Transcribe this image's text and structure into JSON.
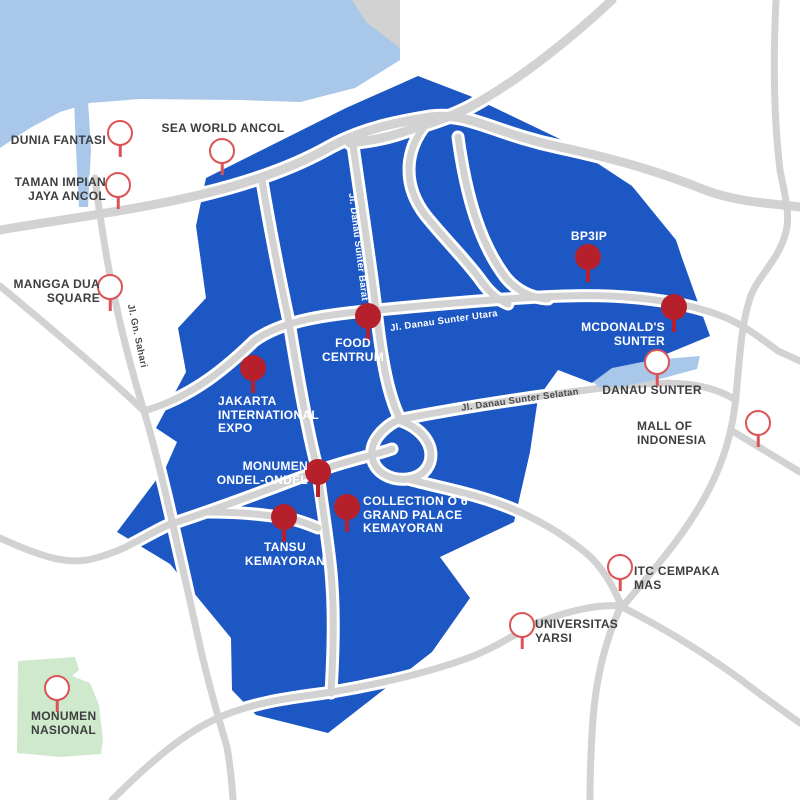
{
  "map_title": "Kemayoran - Sunter area illustrated map",
  "colors": {
    "district_blue": "#1d57c4",
    "water_blue": "#a9c7e9",
    "park_green": "#cfe9cc",
    "road_gray": "#d2d2d2",
    "pin_filled_red": "#b5202b",
    "pin_outline_red": "#dc5356",
    "label_dark": "#3e3e40",
    "label_light": "#ffffff"
  },
  "places": [
    {
      "id": "dunia-fantasi",
      "lines": [
        "DUNIA FANTASI"
      ],
      "pin": "outline"
    },
    {
      "id": "sea-world-ancol",
      "lines": [
        "SEA WORLD ANCOL"
      ],
      "pin": "outline"
    },
    {
      "id": "taman-impian-jaya-ancol",
      "lines": [
        "TAMAN IMPIAN",
        "JAYA ANCOL"
      ],
      "pin": "outline"
    },
    {
      "id": "mangga-dua-square",
      "lines": [
        "MANGGA DUA",
        "SQUARE"
      ],
      "pin": "outline"
    },
    {
      "id": "bp3ip",
      "lines": [
        "BP3IP"
      ],
      "pin": "filled"
    },
    {
      "id": "mcdonalds-sunter",
      "lines": [
        "MCDONALD'S",
        "SUNTER"
      ],
      "pin": "filled"
    },
    {
      "id": "food-centrum",
      "lines": [
        "FOOD",
        "CENTRUM"
      ],
      "pin": "filled"
    },
    {
      "id": "jakarta-international-expo",
      "lines": [
        "JAKARTA",
        "INTERNATIONAL",
        "EXPO"
      ],
      "pin": "filled"
    },
    {
      "id": "monumen-ondel-ondel",
      "lines": [
        "MONUMEN",
        "ONDEL-ONDEL"
      ],
      "pin": "filled"
    },
    {
      "id": "collection-o-6-grand-palace-kemayoran",
      "lines": [
        "COLLECTION O 6",
        "GRAND PALACE",
        "KEMAYORAN"
      ],
      "pin": "filled"
    },
    {
      "id": "tansu-kemayoran",
      "lines": [
        "TANSU",
        "KEMAYORAN"
      ],
      "pin": "filled"
    },
    {
      "id": "danau-sunter",
      "lines": [
        "DANAU SUNTER"
      ],
      "pin": "outline"
    },
    {
      "id": "mall-of-indonesia",
      "lines": [
        "MALL OF INDONESIA"
      ],
      "pin": "outline"
    },
    {
      "id": "itc-cempaka-mas",
      "lines": [
        "ITC CEMPAKA MAS"
      ],
      "pin": "outline"
    },
    {
      "id": "universitas-yarsi",
      "lines": [
        "UNIVERSITAS",
        "YARSI"
      ],
      "pin": "outline"
    },
    {
      "id": "monumen-nasional",
      "lines": [
        "MONUMEN",
        "NASIONAL"
      ],
      "pin": "outline"
    }
  ],
  "road_labels": [
    {
      "id": "jl-gn-sahari",
      "text": "Jl. Gn. Sahari"
    },
    {
      "id": "jl-danau-sunter-barat",
      "text": "Jl. Danau Sunter Barat"
    },
    {
      "id": "jl-danau-sunter-utara",
      "text": "Jl. Danau Sunter Utara"
    },
    {
      "id": "jl-danau-sunter-selatan",
      "text": "Jl. Danau Sunter Selatan"
    }
  ]
}
